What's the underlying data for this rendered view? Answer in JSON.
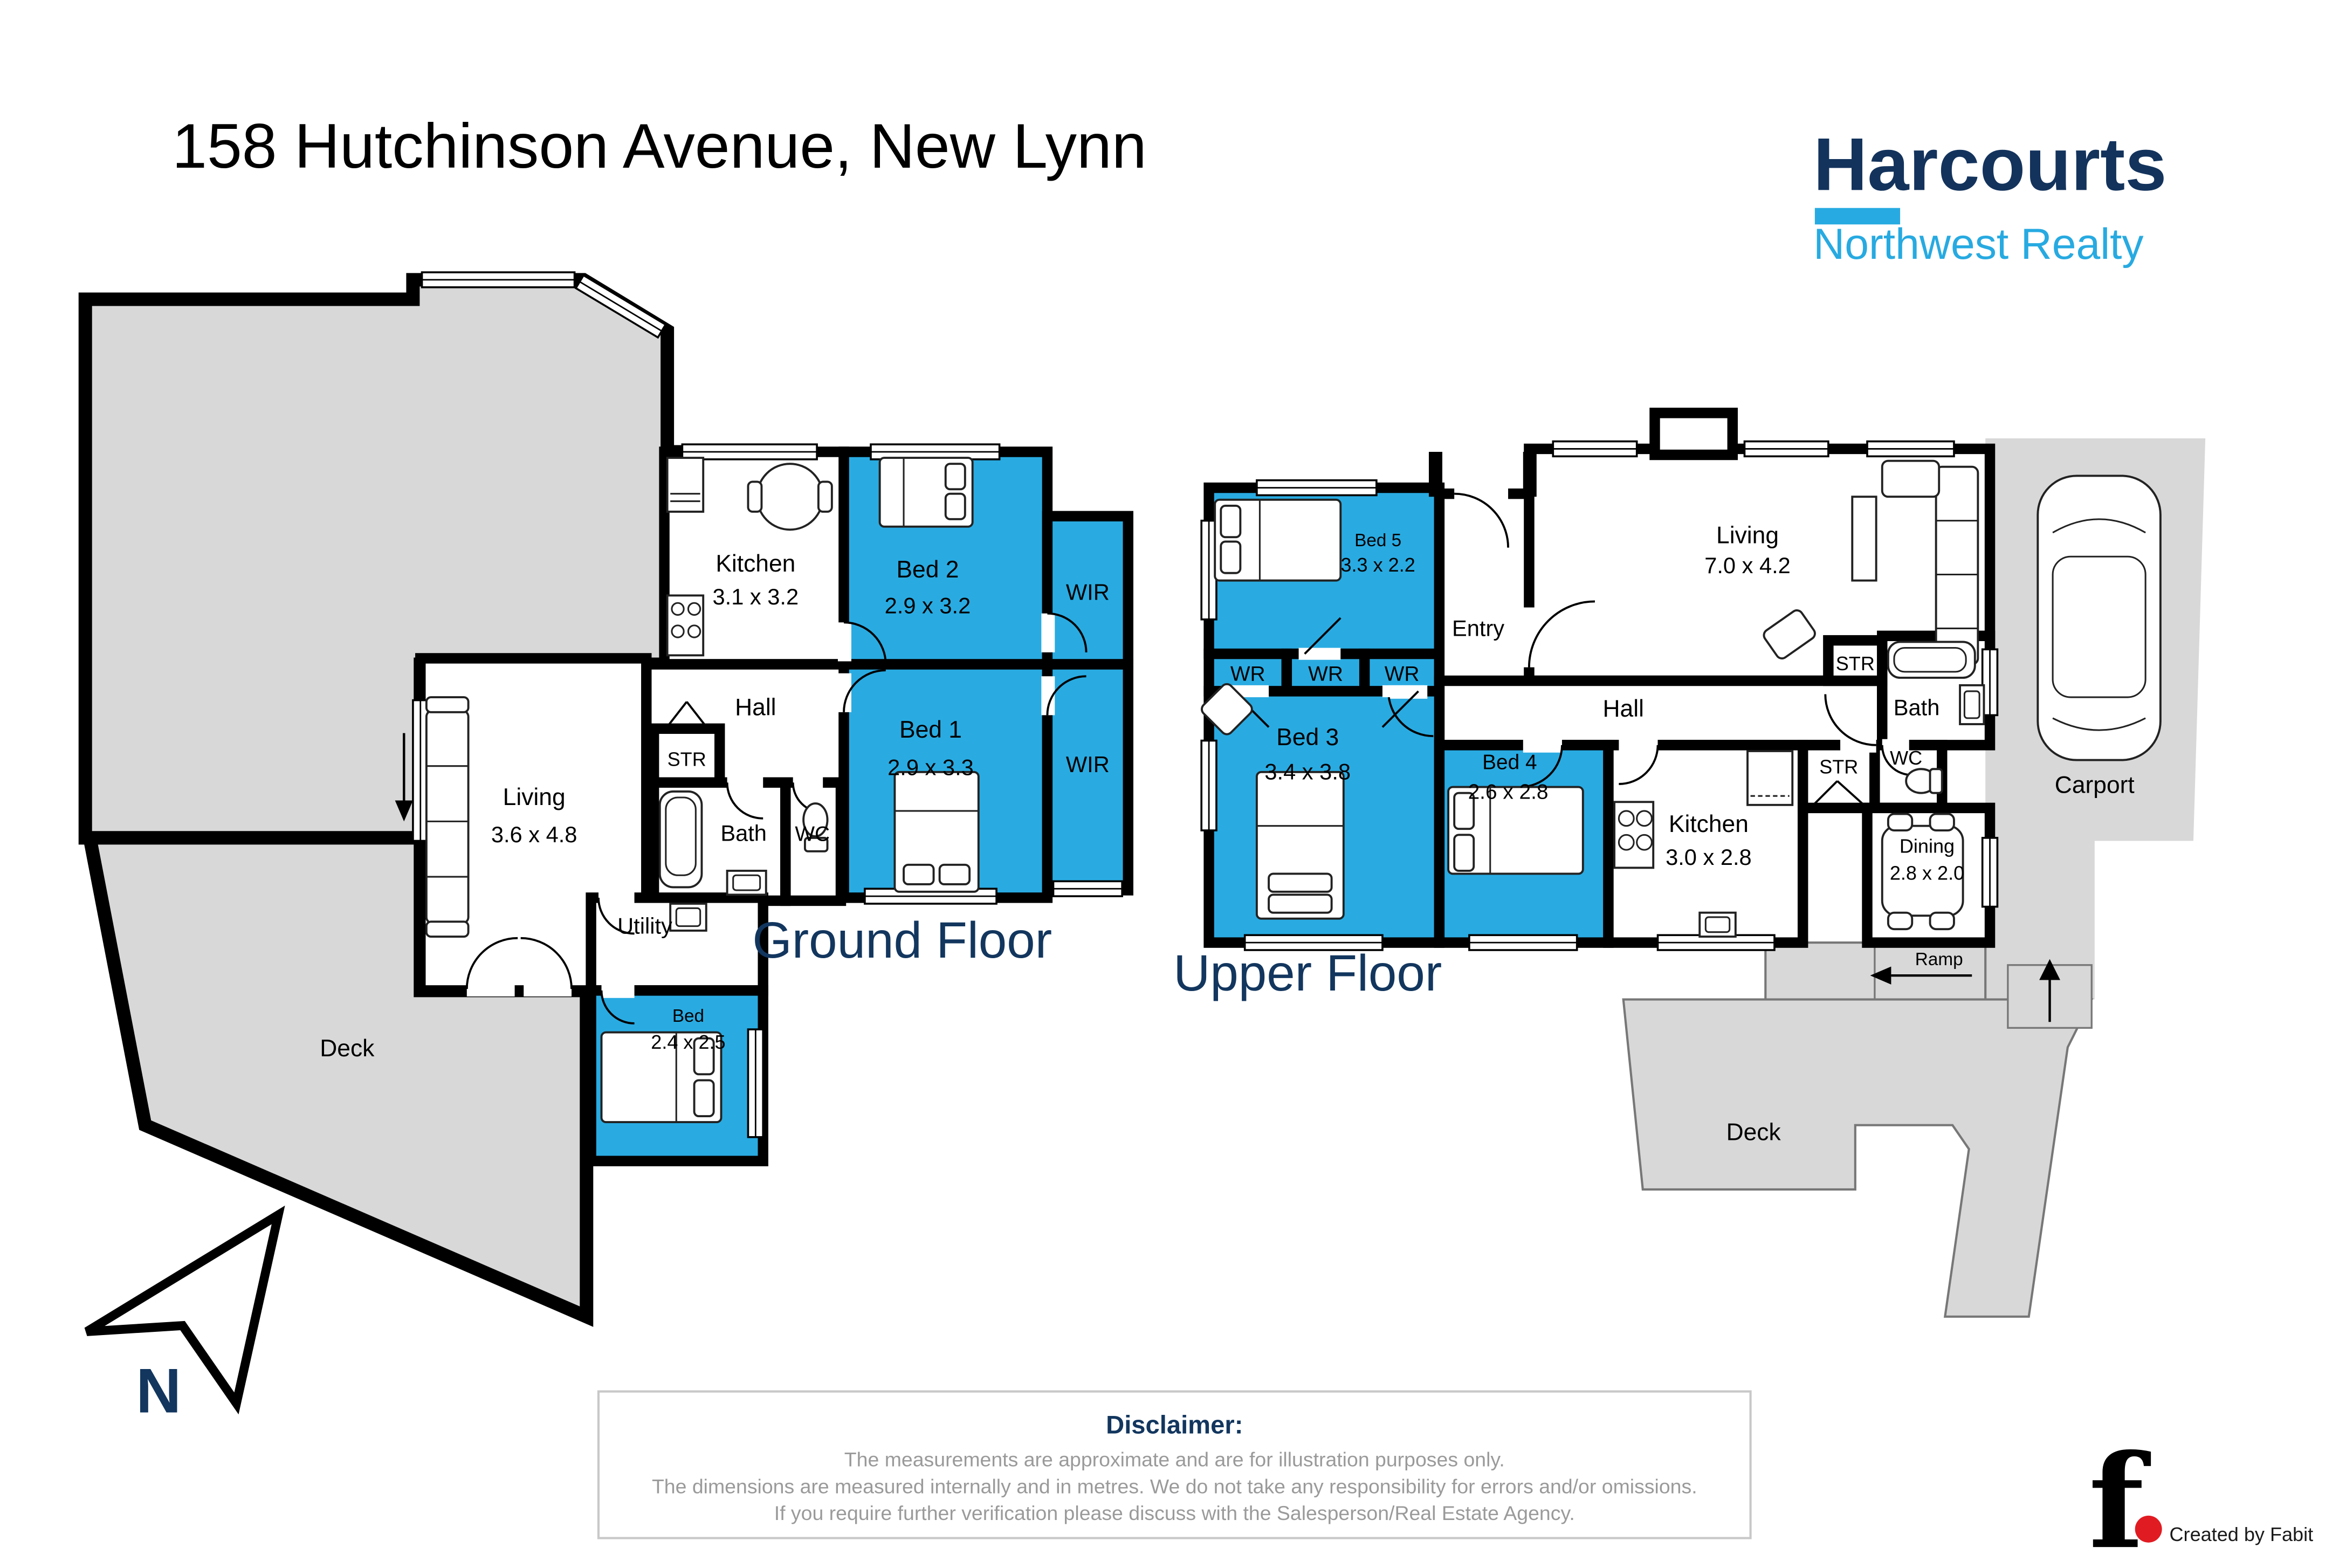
{
  "header": {
    "title": "158 Hutchinson Avenue, New Lynn"
  },
  "logo": {
    "brand": "Harcourts",
    "sub": "Northwest Realty"
  },
  "ground": {
    "label": "Ground Floor",
    "rooms": {
      "kitchen": {
        "name": "Kitchen",
        "dims": "3.1 x 3.2"
      },
      "bed2": {
        "name": "Bed 2",
        "dims": "2.9 x 3.2"
      },
      "wir_top": {
        "name": "WIR"
      },
      "wir_bottom": {
        "name": "WIR"
      },
      "hall": {
        "name": "Hall"
      },
      "bed1": {
        "name": "Bed 1",
        "dims": "2.9 x 3.3"
      },
      "living": {
        "name": "Living",
        "dims": "3.6 x 4.8"
      },
      "str": {
        "name": "STR"
      },
      "bath": {
        "name": "Bath"
      },
      "wc": {
        "name": "WC"
      },
      "utility": {
        "name": "Utility"
      },
      "bed_small": {
        "name": "Bed",
        "dims": "2.4 x 2.5"
      },
      "deck": {
        "name": "Deck"
      }
    }
  },
  "upper": {
    "label": "Upper Floor",
    "rooms": {
      "bed5": {
        "name": "Bed 5",
        "dims": "3.3 x 2.2"
      },
      "wr1": {
        "name": "WR"
      },
      "wr2": {
        "name": "WR"
      },
      "wr3": {
        "name": "WR"
      },
      "entry": {
        "name": "Entry"
      },
      "living": {
        "name": "Living",
        "dims": "7.0 x 4.2"
      },
      "hall": {
        "name": "Hall"
      },
      "str_top": {
        "name": "STR"
      },
      "bath": {
        "name": "Bath"
      },
      "bed3": {
        "name": "Bed 3",
        "dims": "3.4 x 3.8"
      },
      "bed4": {
        "name": "Bed 4",
        "dims": "2.6 x 2.8"
      },
      "kitchen": {
        "name": "Kitchen",
        "dims": "3.0 x 2.8"
      },
      "str_bottom": {
        "name": "STR"
      },
      "wc": {
        "name": "WC"
      },
      "dining": {
        "name": "Dining",
        "dims": "2.8 x 2.0"
      },
      "carport": {
        "name": "Carport"
      },
      "ramp": {
        "name": "Ramp"
      },
      "deck": {
        "name": "Deck"
      }
    }
  },
  "compass": {
    "label": "N"
  },
  "disclaimer": {
    "title": "Disclaimer:",
    "line1": "The measurements are approximate and are for illustration purposes only.",
    "line2": "The dimensions are measured internally and in metres. We do not take any responsibility for errors and/or omissions.",
    "line3": "If you require further verification please discuss with the Salesperson/Real Estate Agency."
  },
  "credit": {
    "symbol": "f",
    "text": "Created by Fabit"
  },
  "colors": {
    "highlight_blue": "#29ABE2",
    "navy": "#12365E",
    "brand_navy": "#13335C",
    "brand_blue": "#27AAE1",
    "deck_gray": "#D8D8D8",
    "wall_black": "#000000",
    "accent_red": "#E11B22",
    "disclaimer_gray": "#9A9A9A"
  }
}
